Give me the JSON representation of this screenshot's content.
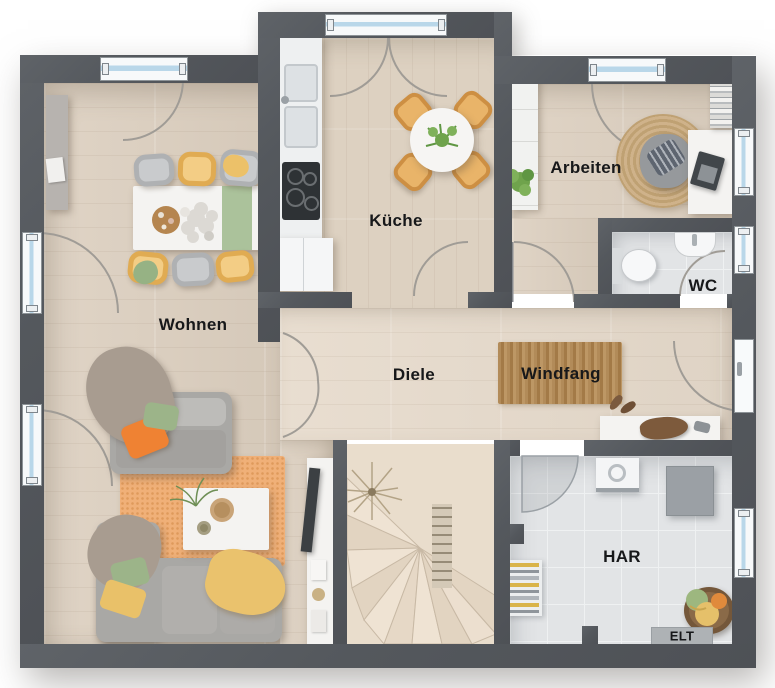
{
  "rooms": [
    {
      "id": "wohnen",
      "label": "Wohnen"
    },
    {
      "id": "kueche",
      "label": "Küche"
    },
    {
      "id": "arbeiten",
      "label": "Arbeiten"
    },
    {
      "id": "wc",
      "label": "WC"
    },
    {
      "id": "diele",
      "label": "Diele"
    },
    {
      "id": "windfang",
      "label": "Windfang"
    },
    {
      "id": "har",
      "label": "HAR"
    },
    {
      "id": "elt",
      "label": "ELT"
    }
  ],
  "colors": {
    "wall": "#54585d",
    "wood_floor": "#ddd0c0",
    "tile_floor": "#e3e5e7",
    "window_glass": "#b9d7e9",
    "accent_yellow": "#eec06a",
    "accent_orange": "#ef8233",
    "accent_green": "#9db88a",
    "rug_terracotta": "#eeab76",
    "rug_jute": "#cdb088",
    "label_text": "#17181a"
  }
}
